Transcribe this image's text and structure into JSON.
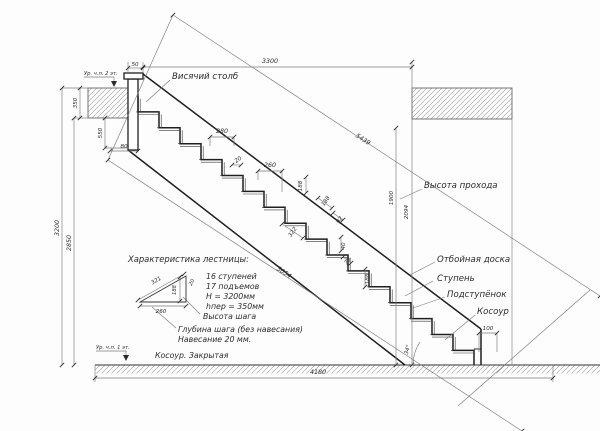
{
  "colors": {
    "ink": "#1f1f1f",
    "dimension_lines": "#7a7a7a",
    "hatch": "#9b9b9b",
    "background": "#fdfdfd"
  },
  "labels": {
    "hanging_post": "Висячий столб",
    "passage_height": "Высота прохода",
    "kick_board": "Отбойная доска",
    "tread": "Ступень",
    "riser": "Подступёнок",
    "stringer": "Косоур",
    "level_2": "Ур. ч.п. 2 эт.",
    "level_1": "Ур. ч.п. 1 эт."
  },
  "dims": {
    "opening_span": "3300",
    "total_run": "4180",
    "total_height": "3200",
    "clear_height": "2850",
    "slab_thickness": "350",
    "post_drop": "550",
    "post_offset": "80",
    "post_cap": "50",
    "tread_full": "280",
    "nosing": "20",
    "tread_clear": "260",
    "riser_height": "188",
    "step_pitch": "322",
    "detail_188a": "188",
    "detail_92": "92",
    "detail_40": "40",
    "detail_20": "20",
    "detail_188b": "188",
    "foot": "100",
    "headroom": "1900",
    "headroom_full": "2094",
    "stringer_outer": "5439",
    "stringer_inner": "5054",
    "slope_angle": "34°"
  },
  "specs": {
    "title": "Характеристика лестницы:",
    "items": [
      "16 ступеней",
      "17 подъемов",
      "H = 3200мм",
      "hпер = 350мм"
    ],
    "step_height": "Высота шага",
    "step_depth": "Глубина шага (без навесания)",
    "overhang_note": "Навесание 20 мм.",
    "stringer_note": "Косоур. Закрытая",
    "tri": {
      "hyp": "321",
      "base": "260",
      "height": "188",
      "nose": "20"
    }
  }
}
